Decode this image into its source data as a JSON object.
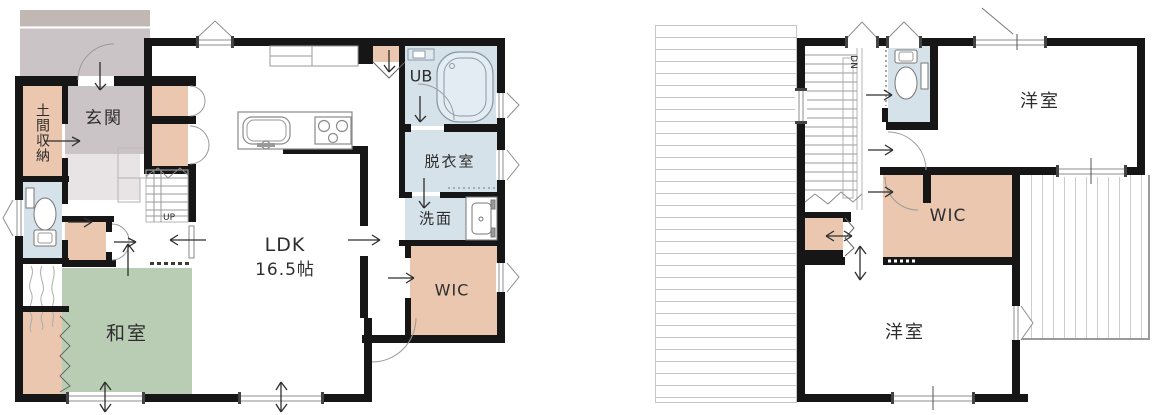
{
  "plan": {
    "type": "floor-plan",
    "floors": [
      "1F",
      "2F"
    ]
  },
  "colors": {
    "wall": "#161616",
    "closet_peach": "#eac7ae",
    "tatami_green": "#b9cdb4",
    "wet_area_blue": "#d6e2ea",
    "porch_gray": "#cbc4c6",
    "porch_band_gray": "#c1b8b4",
    "line_gray": "#8e8e8e"
  },
  "floor1": {
    "genkan": "玄関",
    "doma_shuno": "土間収納",
    "ldk_name": "LDK",
    "ldk_size": "16.5帖",
    "washitsu": "和室",
    "ub": "UB",
    "datsuishitsu": "脱衣室",
    "senmen": "洗面",
    "wic": "WIC",
    "stairs_up": "UP"
  },
  "floor2": {
    "yoshitsu_north": "洋室",
    "yoshitsu_south": "洋室",
    "wic": "WIC",
    "stairs_down": "DN"
  }
}
